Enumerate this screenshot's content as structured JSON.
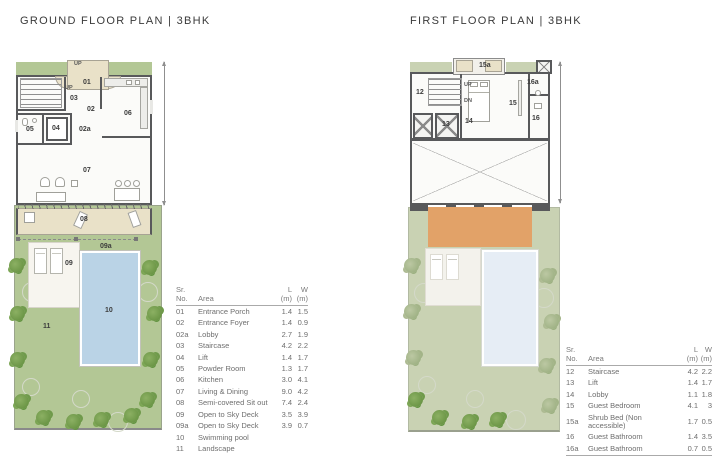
{
  "titles": {
    "ground": "GROUND FLOOR PLAN | 3BHK",
    "first": "FIRST FLOOR PLAN | 3BHK"
  },
  "colors": {
    "wall": "#58595b",
    "landscape_green": "#b3c795",
    "landscape_green_faded": "#c9d2b3",
    "pool_blue": "#bad3e6",
    "pool_blue_faded": "#e6edf5",
    "porch_beige": "#e9e1c8",
    "pergola_orange": "#e2a268",
    "tree_green": "#6f9a4b",
    "deck_cream": "#f7f5ef",
    "text_gray": "#6e6e6e"
  },
  "plans": {
    "ground": {
      "labels": {
        "up_top": "UP",
        "porch": "01",
        "stair_up": "UP",
        "staircase": "03",
        "foyer": "02",
        "kitchen": "06",
        "powder": "05",
        "lift": "04",
        "lobby": "02a",
        "living": "07",
        "sitout": "08",
        "deck_a": "09a",
        "deck": "09",
        "pool": "10",
        "landscape": "11"
      }
    },
    "first": {
      "labels": {
        "shrub": "15a",
        "staircase": "12",
        "up": "UP",
        "dn": "DN",
        "lift": "13",
        "lobby": "14",
        "bedroom": "15",
        "bath": "16",
        "bath_a": "16a"
      }
    }
  },
  "ground_table": {
    "headers": [
      "Sr.\nNo.",
      "Area",
      "L\n(m)",
      "W\n(m)"
    ],
    "rows": [
      [
        "01",
        "Entrance Porch",
        "1.4",
        "1.5"
      ],
      [
        "02",
        "Entrance Foyer",
        "1.4",
        "0.9"
      ],
      [
        "02a",
        "Lobby",
        "2.7",
        "1.9"
      ],
      [
        "03",
        "Staircase",
        "4.2",
        "2.2"
      ],
      [
        "04",
        "Lift",
        "1.4",
        "1.7"
      ],
      [
        "05",
        "Powder Room",
        "1.3",
        "1.7"
      ],
      [
        "06",
        "Kitchen",
        "3.0",
        "4.1"
      ],
      [
        "07",
        "Living & Dining",
        "9.0",
        "4.2"
      ],
      [
        "08",
        "Semi-covered Sit out",
        "7.4",
        "2.4"
      ],
      [
        "09",
        "Open to Sky Deck",
        "3.5",
        "3.9"
      ],
      [
        "09a",
        "Open to Sky Deck",
        "3.9",
        "0.7"
      ],
      [
        "10",
        "Swimming pool",
        "",
        ""
      ],
      [
        "11",
        "Landscape",
        "",
        ""
      ]
    ]
  },
  "first_table": {
    "headers": [
      "Sr.\nNo.",
      "Area",
      "L\n(m)",
      "W\n(m)"
    ],
    "rows": [
      [
        "12",
        "Staircase",
        "4.2",
        "2.2"
      ],
      [
        "13",
        "Lift",
        "1.4",
        "1.7"
      ],
      [
        "14",
        "Lobby",
        "1.1",
        "1.8"
      ],
      [
        "15",
        "Guest Bedroom",
        "4.1",
        "3"
      ],
      [
        "15a",
        "Shrub Bed (Non accessible)",
        "1.7",
        "0.5"
      ],
      [
        "16",
        "Guest Bathroom",
        "1.4",
        "3.5"
      ],
      [
        "16a",
        "Guest Bathroom",
        "0.7",
        "0.5"
      ]
    ]
  }
}
